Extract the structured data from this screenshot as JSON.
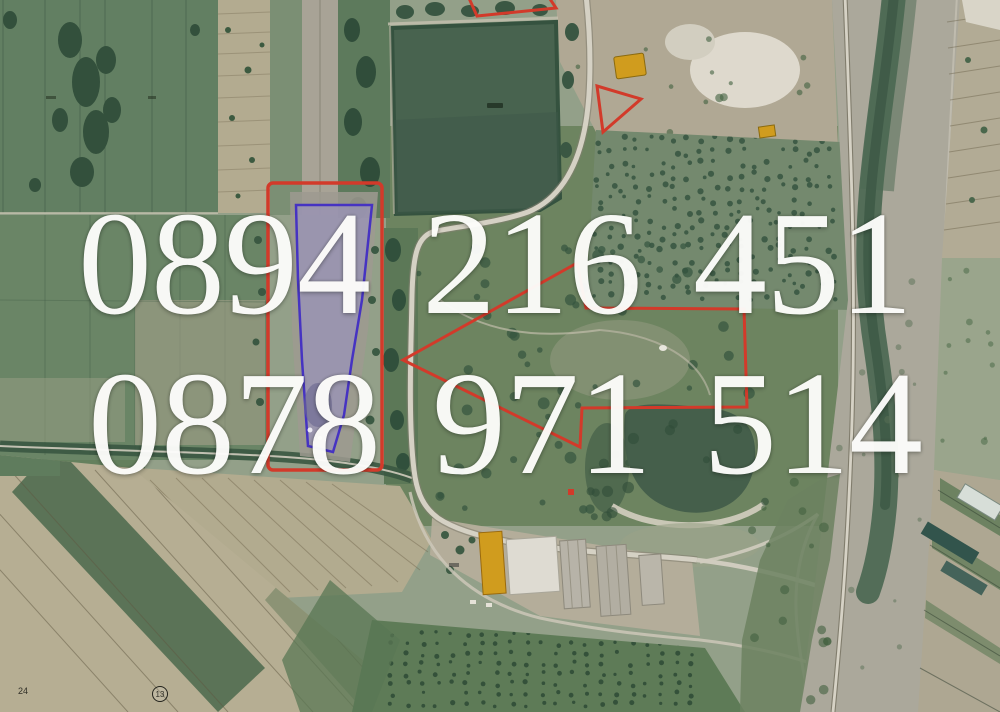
{
  "watermark": {
    "line1": "0894 216 451",
    "line2": "0878 971 514"
  },
  "map_labels": {
    "plot_number": "24",
    "circled_plot_number": "13"
  },
  "colors": {
    "boundary_red": "#d23a2a",
    "parcel_blue": "#4633c2",
    "parcel_fill": "#9a93b8",
    "building_yellow": "#d09c1e",
    "dense_plot_green": "#48634f",
    "pond_green": "#455f4b",
    "field_green": "#63805f",
    "field_beige": "#b3ab92",
    "road_light": "#d5d1c4",
    "canal_green": "#4b6852",
    "corridor_gray": "#aba89b",
    "watermark_white": "#fdfdfb"
  }
}
